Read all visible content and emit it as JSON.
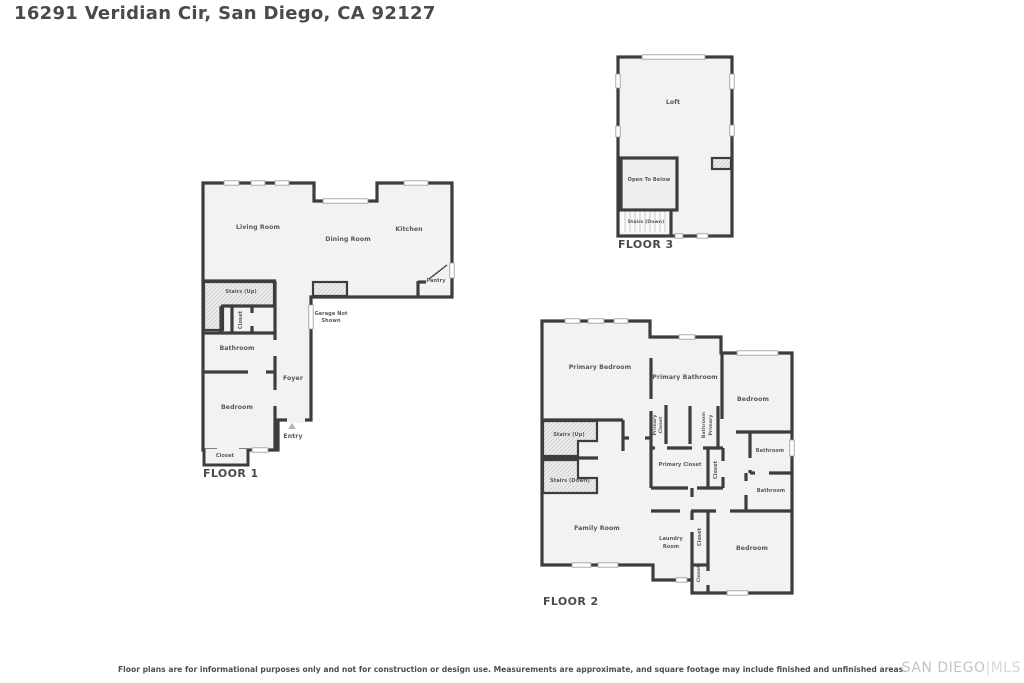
{
  "page": {
    "title": "16291 Veridian Cir, San Diego, CA 92127",
    "disclaimer": "Floor plans are for informational purposes only and not for construction or design use. Measurements are approximate, and square footage may include finished and unfinished areas.",
    "watermark_left": "SAN DIEGO",
    "watermark_right": "|MLS"
  },
  "colors": {
    "wall": "#3d3d3d",
    "floor_fill": "#f2f2f2",
    "hatch_line": "#c9c9c9",
    "window_stroke": "#9a9a9a",
    "label_text": "#575757",
    "heading_text": "#4a4a4a",
    "watermark": "#c3c3c3",
    "entry_arrow": "#b5b5b5"
  },
  "floor1": {
    "name": "FLOOR 1",
    "labels": {
      "living_room": "Living Room",
      "dining_room": "Dining Room",
      "kitchen": "Kitchen",
      "pantry": "Pantry",
      "stairs_up": "Stairs (Up)",
      "closet_upper": "Closet",
      "bathroom": "Bathroom",
      "foyer": "Foyer",
      "bedroom": "Bedroom",
      "entry": "Entry",
      "closet_lower": "Closet",
      "garage_line1": "Garage Not",
      "garage_line2": "Shown"
    }
  },
  "floor2": {
    "name": "FLOOR 2",
    "labels": {
      "primary_bedroom": "Primary Bedroom",
      "primary_bathroom": "Primary Bathroom",
      "bedroom_top": "Bedroom",
      "stairs_up": "Stairs (Up)",
      "stairs_down": "Stairs (Down)",
      "primary_closet_v1": "Primary",
      "primary_closet_v2": "Closet",
      "primary_bathroom_v1": "Bathroom",
      "primary_bathroom_v2": "Primary",
      "primary_closet_room": "Primary Closet",
      "closet_mid": "Closet",
      "bathroom_upper": "Bathroom",
      "bathroom_lower": "Bathroom",
      "family_room": "Family Room",
      "laundry_line1": "Laundry",
      "laundry_line2": "Room",
      "closet_laundry": "Closet",
      "bedroom_bottom": "Bedroom",
      "closet_small": "Closet"
    }
  },
  "floor3": {
    "name": "FLOOR 3",
    "labels": {
      "loft": "Loft",
      "open_to_below": "Open To Below",
      "stairs_down": "Stairs (Down)"
    }
  }
}
